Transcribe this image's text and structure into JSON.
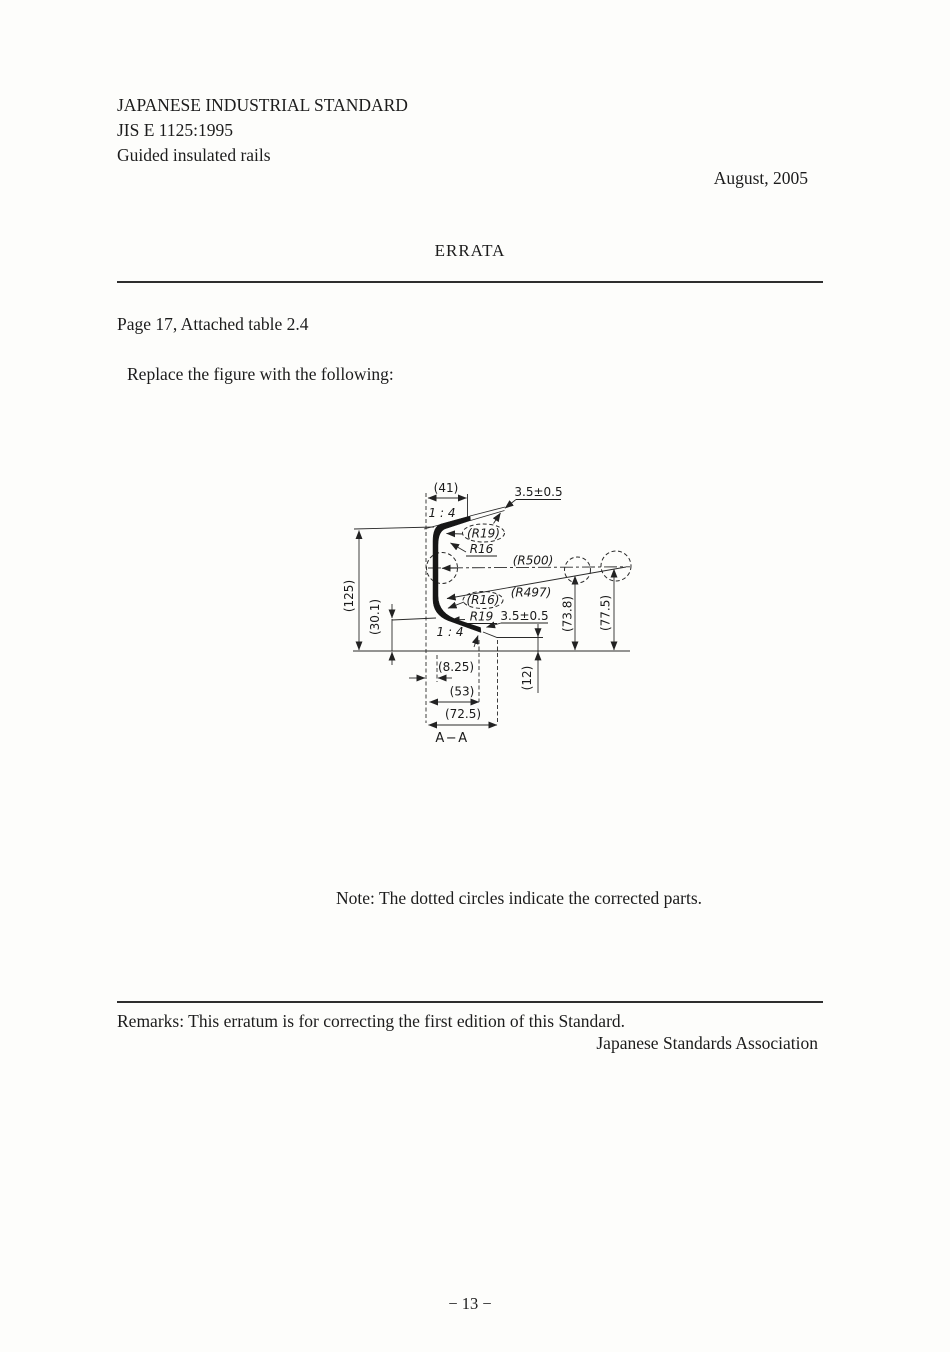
{
  "document": {
    "standard_name": "JAPANESE INDUSTRIAL STANDARD",
    "standard_number": "JIS E 1125:1995",
    "standard_title": "Guided insulated rails",
    "date": "August, 2005",
    "errata_title": "ERRATA",
    "reference": "Page 17, Attached table 2.4",
    "instruction": "Replace the figure with the following:",
    "note": "Note: The dotted circles indicate the corrected parts.",
    "remarks": "Remarks: This erratum is for correcting the first edition of this Standard.",
    "association": "Japanese Standards Association",
    "page_number": "− 13 −"
  },
  "figure": {
    "section_label": "A−A",
    "labels": {
      "width_top": "(41)",
      "thickness_top": "3.5±0.5",
      "slope_top": "1 : 4",
      "radius_r19_top": "(R19)",
      "radius_r16_top": "R16",
      "radius_r500": "(R500)",
      "radius_r16_bottom": "(R16)",
      "radius_r497": "(R497)",
      "radius_r19_bottom": "R19",
      "thickness_bottom": "3.5±0.5",
      "height_overall": "(125)",
      "height_lower": "(30.1)",
      "slope_bottom": "1 : 4",
      "width_8_25": "(8.25)",
      "width_53": "(53)",
      "width_72_5": "(72.5)",
      "offset_12": "(12)",
      "height_73_8": "(73.8)",
      "height_77_5": "(77.5)"
    }
  }
}
